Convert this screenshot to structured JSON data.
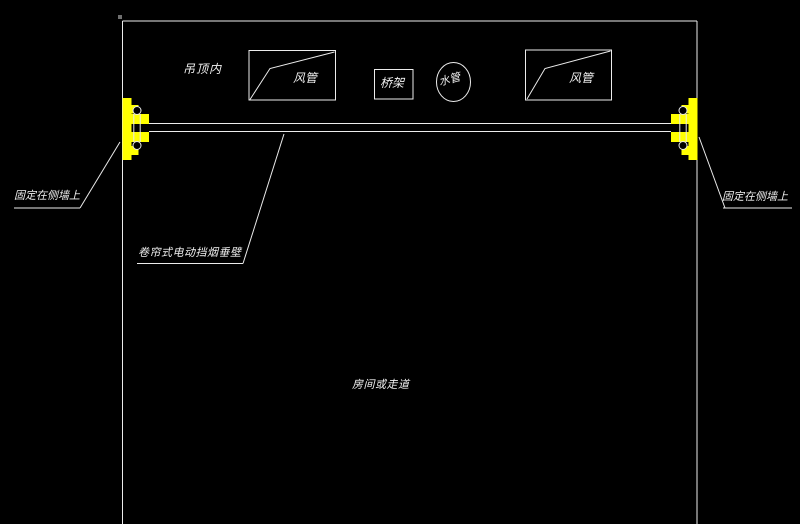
{
  "colors": {
    "background": "#000000",
    "line": "#ececec",
    "text": "#f0f0f0",
    "bracket_yellow": "#ffff00"
  },
  "annotations": {
    "ceiling_zone": "吊顶内",
    "duct_left": "风管",
    "cable_tray": "桥架",
    "water_pipe": "水管",
    "duct_right": "风管",
    "fixed_on_side_wall_left": "固定在侧墙上",
    "fixed_on_side_wall_right": "固定在侧墙上",
    "smoke_barrier": "卷帘式电动挡烟垂壁",
    "room_or_corridor": "房间或走道"
  }
}
